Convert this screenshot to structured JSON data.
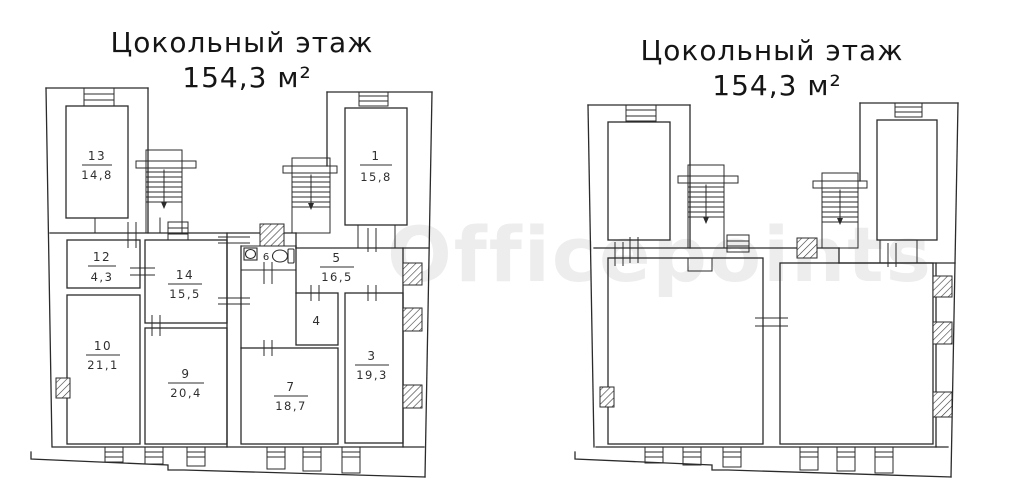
{
  "left_plan": {
    "title_line1": "Цокольный этаж",
    "title_line2": "154,3 м²",
    "rooms": [
      {
        "number": "13",
        "area": "14,8"
      },
      {
        "number": "12",
        "area": "4,3"
      },
      {
        "number": "10",
        "area": "21,1"
      },
      {
        "number": "14",
        "area": "15,5"
      },
      {
        "number": "9",
        "area": "20,4"
      },
      {
        "number": "5",
        "area": "16,5"
      },
      {
        "number": "3",
        "area": "19,3"
      },
      {
        "number": "7",
        "area": "18,7"
      },
      {
        "number": "1",
        "area": "15,8"
      },
      {
        "number": "4",
        "area": ""
      },
      {
        "number": "6",
        "area": ""
      }
    ]
  },
  "right_plan": {
    "title_line1": "Цокольный этаж",
    "title_line2": "154,3 м²"
  },
  "watermark": {
    "text": "Officepoints",
    "color": "#ededed"
  },
  "icons": {
    "stairs_down_arrow": "▼",
    "toilet": "toilet-shape",
    "sink": "sink-shape"
  },
  "colors": {
    "line": "#2b2b2b",
    "background": "#ffffff"
  }
}
